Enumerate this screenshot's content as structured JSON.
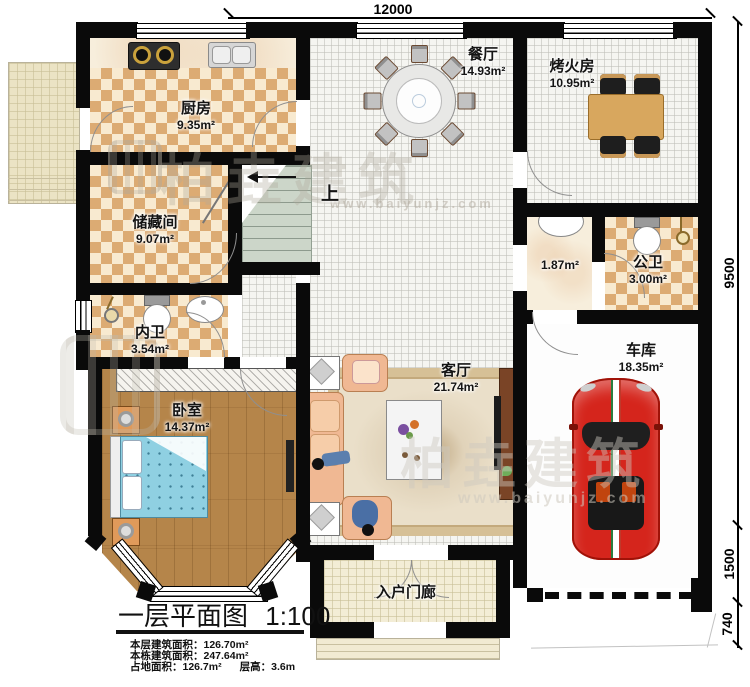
{
  "plan_title": {
    "label": "一层平面图",
    "scale": "1:100"
  },
  "info": {
    "line1_label": "本层建筑面积：",
    "line1_value": "126.70m²",
    "line2_label": "本栋建筑面积：",
    "line2_value": "247.64m²",
    "line3_label": "占地面积：",
    "line3_value": "126.7m²",
    "line4_label": "层高：",
    "line4_value": "3.6m"
  },
  "dimensions": {
    "top": "12000",
    "right_main": "9500",
    "right_mid": "1500",
    "right_bottom": "740"
  },
  "rooms": {
    "kitchen": {
      "name": "厨房",
      "area": "9.35m²"
    },
    "dining": {
      "name": "餐厅",
      "area": "14.93m²"
    },
    "fire": {
      "name": "烤火房",
      "area": "10.95m²"
    },
    "storage": {
      "name": "储藏间",
      "area": "9.07m²"
    },
    "hall_basin": {
      "area": "1.87m²"
    },
    "public_wc": {
      "name": "公卫",
      "area": "3.00m²"
    },
    "inner_wc": {
      "name": "内卫",
      "area": "3.54m²"
    },
    "bedroom": {
      "name": "卧室",
      "area": "14.37m²"
    },
    "living": {
      "name": "客厅",
      "area": "21.74m²"
    },
    "garage": {
      "name": "车库",
      "area": "18.35m²"
    },
    "porch": {
      "name": "入户门廊"
    }
  },
  "stairs": {
    "up_label": "上"
  },
  "watermark": {
    "brand": "柏垚建筑",
    "url": "www.baiyunjz.com"
  },
  "colors": {
    "wall": "#0a0a0a",
    "floor_tan": "#dcab73",
    "wood": "#b5854a",
    "car": "#d5251c",
    "sofa": "#f0b893"
  }
}
